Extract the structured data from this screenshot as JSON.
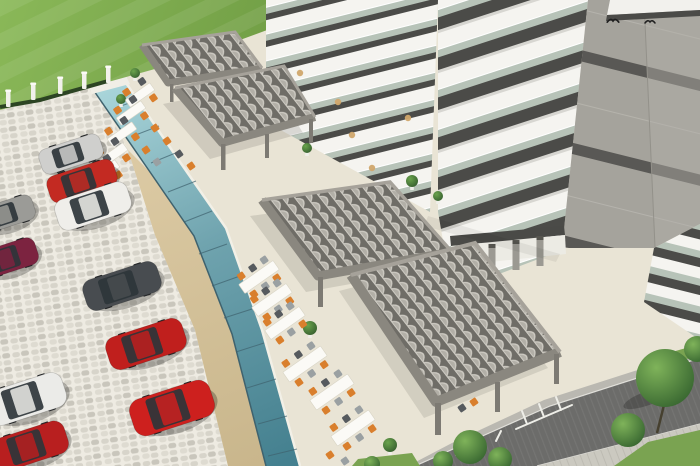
{
  "meta": {
    "type": "3d-architectural-rendering",
    "caption": "Aerial 3D render of a residential complex: white high-rise with dark balcony bands, cafe terrace with gray slatted pergolas and dining sets, cobblestone parking lot with cars, lawn with fence, teal glass pool-edge balustrade, and a street with trees"
  },
  "palette": {
    "terrace": "#e9e4d5",
    "cobble_joint": "#eeebe2",
    "stone1": "#d7d4ca",
    "stone2": "#c9c6bc",
    "stone3": "#dedbd1",
    "sand1": "#dccaa4",
    "sand2": "#c9b68c",
    "glass_frame": "#3f626e",
    "glass_coping": "#f2f0e7",
    "grass1": "#8ab858",
    "grass2": "#6d9a42",
    "hedge": "#2c4423",
    "post_white": "#f2f1ec",
    "bldg_white": "#f5f4f0",
    "slab_dark": "#4b4b48",
    "glass_green": "#b7c3b8",
    "side_wall": "#a5a39c",
    "side_band": "#595855",
    "side_wall2": "#b2b0a9",
    "pergola_gap": "#6f6d67",
    "pergola_slat_light": "#cecbc3",
    "pergola_slat_mid": "#b2afa7",
    "pergola_beam": "#8a877f",
    "pergola_beam_light": "#a6a29a",
    "pergola_post": "#7d7a73",
    "table_white": "#fbfaf6",
    "chair_orange": "#d97f2d",
    "chair_gray": "#9aa0a2",
    "chair_dark": "#565a5e",
    "road": "#6c6c6a",
    "curb": "#bab8b1",
    "walk": "#cbc9c0",
    "verge": "#7aa351",
    "trunk": "#46402f",
    "car_glass": "#2e3539",
    "mark_white": "#eeeee8"
  },
  "scene": {
    "canvas": {
      "w": 700,
      "h": 466
    },
    "fence_posts": [
      [
        8,
        104
      ],
      [
        33,
        97
      ],
      [
        60,
        91
      ],
      [
        84,
        86
      ],
      [
        108,
        80
      ]
    ],
    "glass_seams": [
      [
        115,
        108,
        141,
        99
      ],
      [
        133,
        136,
        159,
        126
      ],
      [
        151,
        163,
        178,
        152
      ],
      [
        168,
        192,
        196,
        181
      ],
      [
        184,
        222,
        212,
        211
      ],
      [
        199,
        254,
        227,
        244
      ],
      [
        212,
        286,
        240,
        276
      ],
      [
        224,
        318,
        252,
        309
      ],
      [
        236,
        352,
        264,
        343
      ],
      [
        247,
        388,
        276,
        379
      ],
      [
        258,
        424,
        287,
        416
      ],
      [
        268,
        456,
        297,
        449
      ]
    ],
    "parasols": [
      [
        338,
        102
      ],
      [
        352,
        135
      ],
      [
        372,
        168
      ],
      [
        408,
        118
      ],
      [
        300,
        73
      ]
    ],
    "columns": [
      [
        468,
        248
      ],
      [
        492,
        244
      ],
      [
        516,
        240
      ],
      [
        540,
        236
      ]
    ],
    "road_markings": {
      "bay_line": [
        516,
        429,
        572,
        405
      ],
      "bay_teeth": [
        [
          527,
          424,
          522,
          411
        ],
        [
          544,
          417,
          539,
          404
        ],
        [
          561,
          410,
          556,
          397
        ]
      ],
      "ticks": [
        [
          436,
          462,
          441,
          452
        ],
        [
          456,
          455,
          461,
          445
        ],
        [
          476,
          448,
          481,
          438
        ],
        [
          496,
          441,
          501,
          431
        ]
      ]
    },
    "trees": [
      [
        665,
        378,
        29
      ],
      [
        628,
        430,
        17
      ],
      [
        697,
        349,
        13
      ],
      [
        470,
        447,
        17
      ],
      [
        500,
        459,
        12
      ],
      [
        443,
        461,
        10
      ],
      [
        372,
        464,
        8
      ]
    ],
    "shrubs": [
      [
        310,
        328,
        7
      ],
      [
        390,
        445,
        7
      ],
      [
        412,
        181,
        6
      ],
      [
        438,
        196,
        5
      ],
      [
        135,
        73,
        5
      ],
      [
        121,
        99,
        5
      ],
      [
        307,
        148,
        5
      ]
    ],
    "tables": [
      {
        "cx": 140,
        "cy": 95,
        "l": 30,
        "w": 9,
        "a": -35,
        "chairs": 4
      },
      {
        "cx": 131,
        "cy": 113,
        "l": 30,
        "w": 9,
        "a": -35,
        "chairs": 4
      },
      {
        "cx": 122,
        "cy": 134,
        "l": 30,
        "w": 9,
        "a": -35,
        "chairs": 4
      },
      {
        "cx": 113,
        "cy": 155,
        "l": 30,
        "w": 9,
        "a": -35,
        "chairs": 4
      },
      {
        "cx": 105,
        "cy": 172,
        "l": 30,
        "w": 9,
        "a": -35,
        "chairs": 4
      },
      {
        "cx": 259,
        "cy": 277,
        "l": 42,
        "w": 11,
        "a": -35,
        "chairs": 6
      },
      {
        "cx": 272,
        "cy": 300,
        "l": 42,
        "w": 11,
        "a": -35,
        "chairs": 6
      },
      {
        "cx": 285,
        "cy": 323,
        "l": 42,
        "w": 11,
        "a": -35,
        "chairs": 6
      },
      {
        "cx": 305,
        "cy": 364,
        "l": 46,
        "w": 12,
        "a": -35,
        "chairs": 6
      },
      {
        "cx": 332,
        "cy": 392,
        "l": 46,
        "w": 12,
        "a": -35,
        "chairs": 6
      },
      {
        "cx": 353,
        "cy": 428,
        "l": 46,
        "w": 12,
        "a": -35,
        "chairs": 6
      }
    ],
    "extra_chairs": [
      [
        155,
        128,
        "orange"
      ],
      [
        167,
        141,
        "orange"
      ],
      [
        179,
        154,
        "dark"
      ],
      [
        191,
        166,
        "orange"
      ],
      [
        157,
        162,
        "gray"
      ],
      [
        146,
        150,
        "orange"
      ],
      [
        330,
        455,
        "orange"
      ],
      [
        345,
        461,
        "gray"
      ],
      [
        474,
        402,
        "orange"
      ],
      [
        462,
        408,
        "dark"
      ]
    ],
    "cars": [
      {
        "name": "silver-sedan",
        "cx": 71,
        "cy": 154,
        "l": 64,
        "w": 26,
        "a": -18,
        "color": "#cfcfcd"
      },
      {
        "name": "red-car",
        "cx": 82,
        "cy": 181,
        "l": 70,
        "w": 28,
        "a": -18,
        "color": "#c32a22"
      },
      {
        "name": "white-minivan",
        "cx": 93,
        "cy": 206,
        "l": 76,
        "w": 32,
        "a": -18,
        "color": "#efeeea"
      },
      {
        "name": "gray-car",
        "cx": 6,
        "cy": 214,
        "l": 58,
        "w": 26,
        "a": -18,
        "color": "#9b9b97"
      },
      {
        "name": "maroon-car",
        "cx": 8,
        "cy": 258,
        "l": 60,
        "w": 28,
        "a": -18,
        "color": "#7c2340"
      },
      {
        "name": "dark-gray-coupe",
        "cx": 122,
        "cy": 286,
        "l": 78,
        "w": 32,
        "a": -18,
        "color": "#484c50"
      },
      {
        "name": "red-coupe",
        "cx": 146,
        "cy": 344,
        "l": 80,
        "w": 34,
        "a": -18,
        "color": "#c01f1d"
      },
      {
        "name": "white-minivan-2",
        "cx": 26,
        "cy": 399,
        "l": 80,
        "w": 36,
        "a": -18,
        "color": "#ebebe8"
      },
      {
        "name": "red-hatchback",
        "cx": 172,
        "cy": 408,
        "l": 84,
        "w": 38,
        "a": -18,
        "color": "#cd201e"
      },
      {
        "name": "red-car-2",
        "cx": 30,
        "cy": 446,
        "l": 76,
        "w": 34,
        "a": -18,
        "color": "#b81f1f"
      }
    ],
    "birds": [
      [
        613,
        21
      ],
      [
        650,
        22
      ]
    ]
  }
}
